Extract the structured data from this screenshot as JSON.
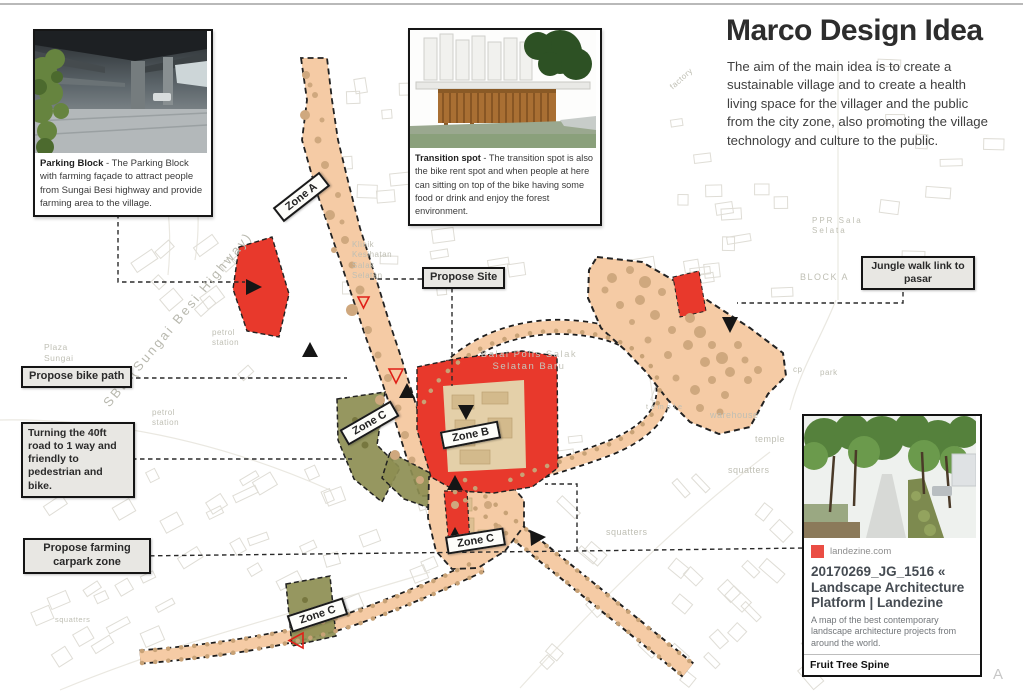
{
  "header": {
    "title": "Marco Design Idea",
    "body": "The aim of the main idea is to create a sustainable village and to create a health living space for the villager and the public from the city zone, also promoting the village technology and culture to the public."
  },
  "callouts": {
    "parking": {
      "title": "Parking Block",
      "text": " - The Parking Block with farming façade to attract people from Sungai Besi highway and provide farming area to the village."
    },
    "transition": {
      "title": "Transition spot",
      "text": "  - The transition spot is also the bike rent spot and when people at here can sitting on top of the bike having some food or drink and enjoy the forest environment."
    }
  },
  "notes": {
    "propose_site": "Propose Site",
    "bike_path": "Propose bike path",
    "turning": "Turning the 40ft road to 1 way and friendly to pedestrian and bike.",
    "farming": "Propose farming carpark zone",
    "jungle": "Jungle walk link to pasar"
  },
  "zones": {
    "a": "Zone A",
    "b": "Zone B",
    "c": "Zone C"
  },
  "map_labels": {
    "plaza": "Plaza\nSungai\nBesi",
    "sbe": "SBE (Sungai Besi Highway)",
    "petrol": "petrol\nstation",
    "klinik": "Klinik\nKesihatan\nSalak\nSelatan",
    "balai": "Balai Polis Salak\nSelatan Baru",
    "factory": "factory",
    "ppr": "PPR Sala\nSelata",
    "block_a": "BLOCK A",
    "cp": "cp",
    "park": "park",
    "warehouse": "warehouse",
    "temple": "temple",
    "squatters": "squatters"
  },
  "card": {
    "source": "landezine.com",
    "title": "20170269_JG_1516 « Landscape Architecture Platform | Landezine",
    "description": "A map of the best contemporary landscape architecture projects from around the world.",
    "footer": "Fruit Tree Spine"
  },
  "corner_mark": "A",
  "colors": {
    "path_peach": "#f5cba5",
    "zone_red": "#e8392c",
    "zone_olive": "#8d8e52",
    "tag_bg": "#e8e7e3",
    "accent_red": "#ea4d44"
  }
}
